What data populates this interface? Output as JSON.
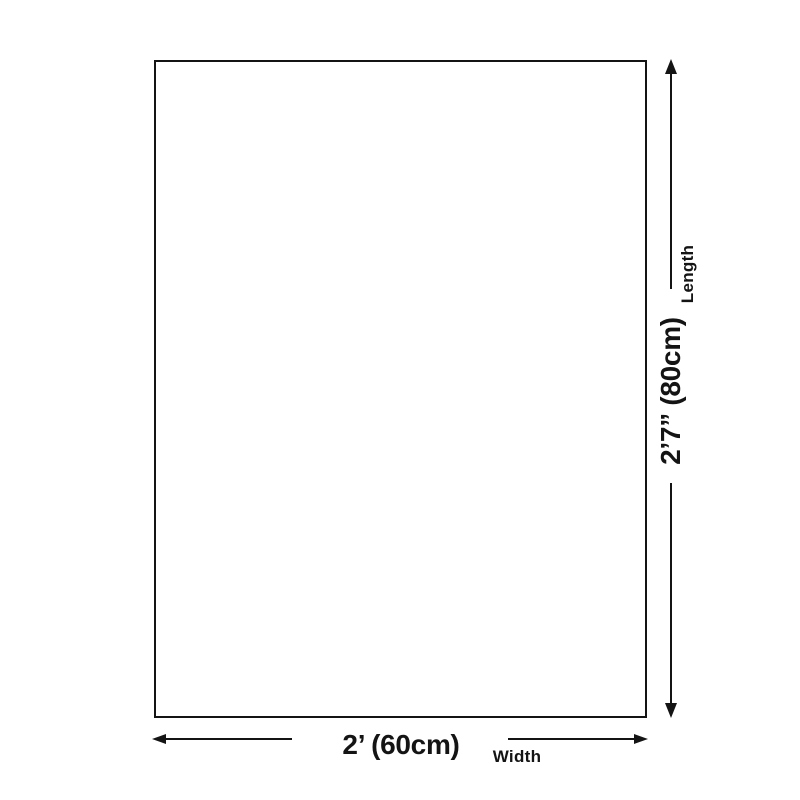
{
  "theme": {
    "background": "#ffffff",
    "ink": "#141414"
  },
  "diagram": {
    "length_dimension": {
      "label": "Length",
      "value": "2’7” (80cm)"
    },
    "width_dimension": {
      "label": "Width",
      "value": "2’ (60cm)"
    },
    "icons": {
      "length_top": "arrow-up-icon",
      "length_bottom": "arrow-down-icon",
      "width_left": "arrow-left-icon",
      "width_right": "arrow-right-icon"
    }
  }
}
